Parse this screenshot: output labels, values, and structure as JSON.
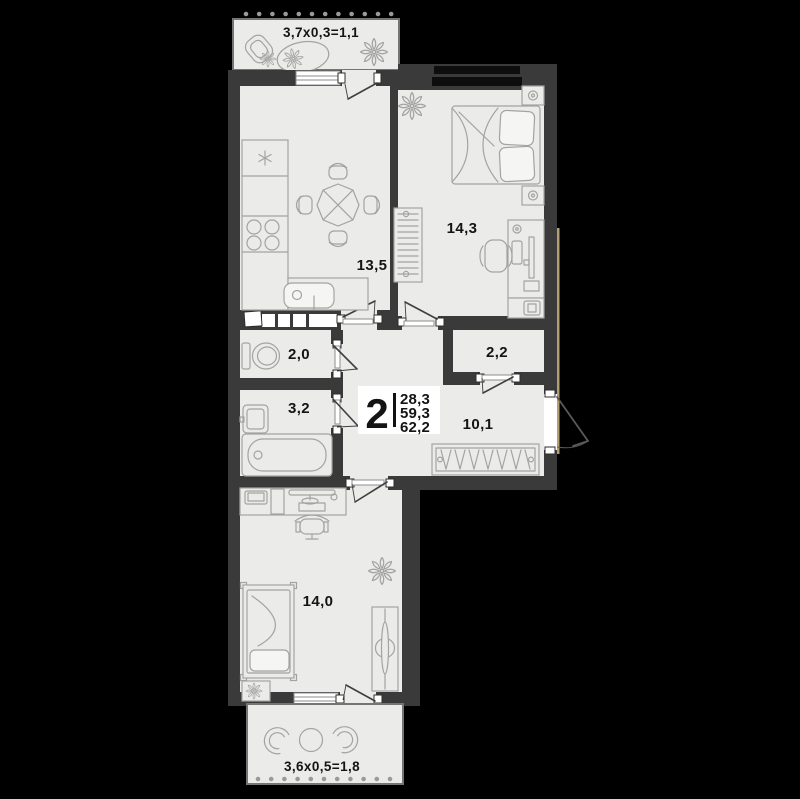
{
  "plan": {
    "summary": {
      "rooms_count": "2",
      "living_area": "28,3",
      "area": "59,3",
      "total_area": "62,2"
    },
    "rooms": [
      {
        "id": "kitchen-living",
        "area": "13,5"
      },
      {
        "id": "bedroom",
        "area": "14,3"
      },
      {
        "id": "toilet",
        "area": "2,0"
      },
      {
        "id": "bathroom",
        "area": "3,2"
      },
      {
        "id": "wardrobe-room",
        "area": "2,2"
      },
      {
        "id": "hallway",
        "area": "10,1"
      },
      {
        "id": "room",
        "area": "14,0"
      }
    ],
    "balconies": [
      {
        "id": "balcony-top",
        "label": "3,7х0,3=1,1"
      },
      {
        "id": "balcony-bottom",
        "label": "3,6х0,5=1,8"
      }
    ],
    "colors": {
      "background": "#000000",
      "wall": "#3a3a3a",
      "floor": "#ebebe9",
      "furniture_stroke": "#a3a3a1",
      "door_stroke": "#3f3f3f",
      "text": "#141414",
      "window_glass": "#0d0d0d",
      "accent_line": "#b1a172",
      "info_box_bg": "#ffffff"
    }
  }
}
